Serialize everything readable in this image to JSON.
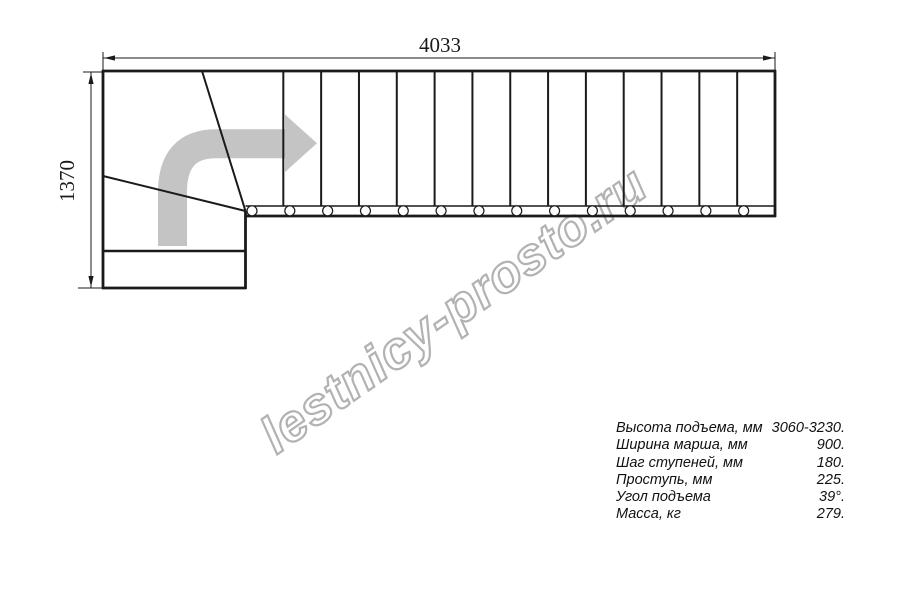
{
  "drawing": {
    "dim_width_label": "4033",
    "dim_height_label": "1370",
    "straight_treads": 14,
    "direction": "up-then-right",
    "colors": {
      "line": "#1a1a1a",
      "arrow_gray": "#c4c4c4",
      "watermark_gray": "#b2b2b2"
    }
  },
  "watermark": {
    "text": "lestnicy-prosto.ru"
  },
  "specs": {
    "rows": [
      {
        "label": "Высота подъема, мм",
        "value": "3060-3230."
      },
      {
        "label": "Ширина марша, мм",
        "value": "900."
      },
      {
        "label": "Шаг ступеней, мм",
        "value": "180."
      },
      {
        "label": "Проступь, мм",
        "value": "225."
      },
      {
        "label": "Угол подъема",
        "value": "39°."
      },
      {
        "label": "Масса, кг",
        "value": "279."
      }
    ]
  }
}
